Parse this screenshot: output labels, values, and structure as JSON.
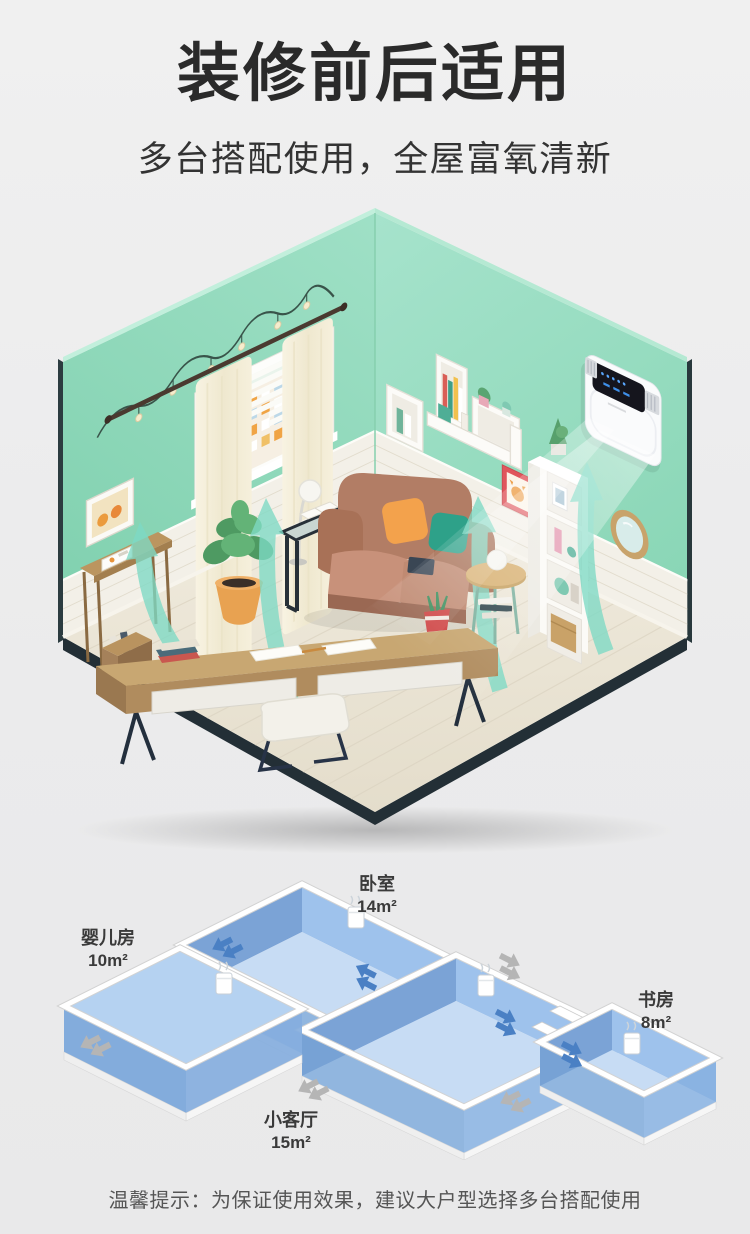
{
  "header": {
    "title": "装修前后适用",
    "subtitle": "多台搭配使用，全屋富氧清新"
  },
  "room_scene": {
    "wall_color": "#92d8ba",
    "floor_color": "#ebe4d6",
    "airflow_color": "#7edac5",
    "device_body_color": "#fafbfc",
    "device_display_color": "#15151d"
  },
  "floor_plan": {
    "rooms": [
      {
        "name": "婴儿房",
        "area": "10m²"
      },
      {
        "name": "卧室",
        "area": "14m²"
      },
      {
        "name": "小客厅",
        "area": "15m²"
      },
      {
        "name": "书房",
        "area": "8m²"
      }
    ],
    "room_fill": "#aecdee",
    "arrow_blue": "#4a80c4",
    "arrow_gray": "#b5b5b5"
  },
  "footer": {
    "tip": "温馨提示：为保证使用效果，建议大户型选择多台搭配使用"
  }
}
